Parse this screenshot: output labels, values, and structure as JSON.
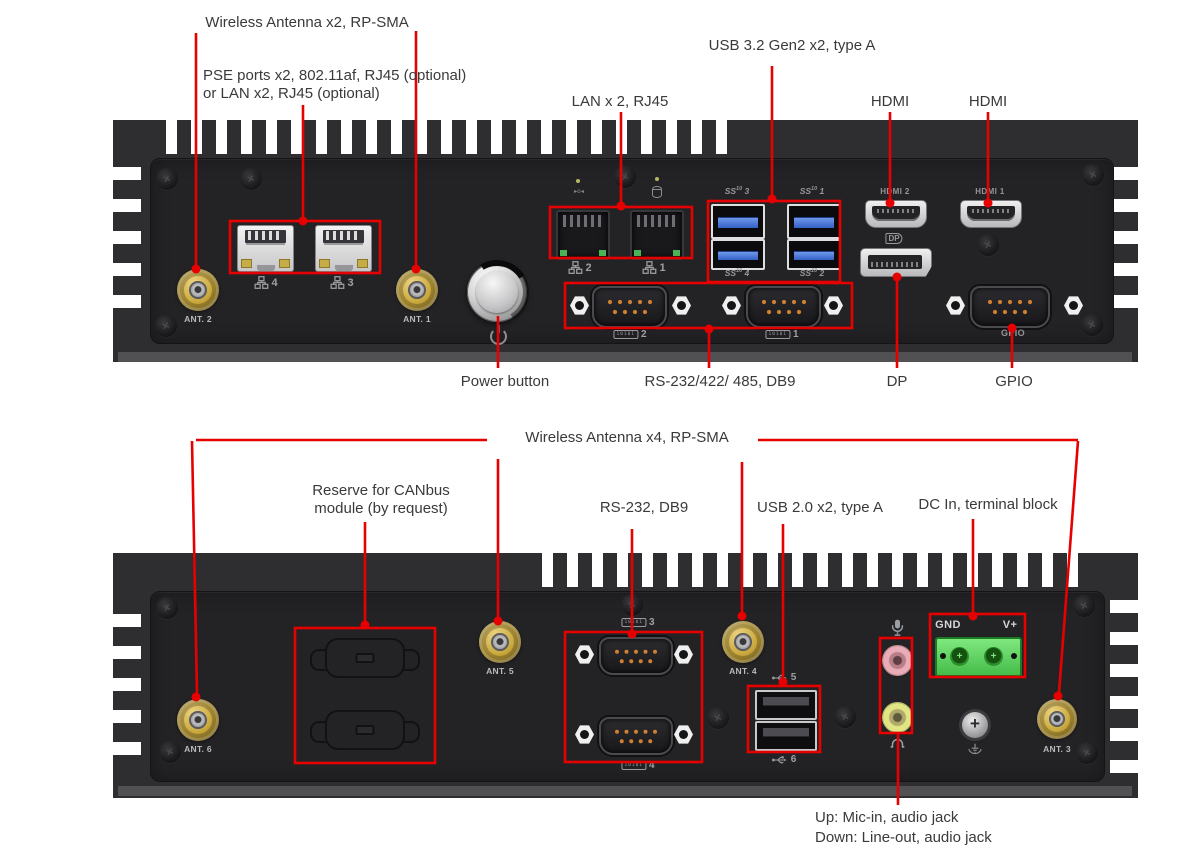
{
  "colors": {
    "annotation_red": "#e60000",
    "chassis_gray": "#2e2e30",
    "faceplate_gray": "#232326",
    "antenna_gold": "#c9a83d",
    "usb3_blue": "#3f6fd8",
    "terminal_green": "#57d157",
    "mic_jack_pink": "#eaacb6",
    "lineout_jack_lime": "#e2e584"
  },
  "top_view": {
    "callouts": {
      "wireless_antenna": "Wireless Antenna x2, RP-SMA",
      "pse_line1": "PSE ports x2, 802.11af, RJ45 (optional)",
      "pse_line2": "or LAN x2, RJ45 (optional)",
      "lan": "LAN x 2, RJ45",
      "usb": "USB 3.2 Gen2 x2, type A",
      "hdmi_left": "HDMI",
      "hdmi_right": "HDMI",
      "power_button": "Power button",
      "serial": "RS-232/422/ 485, DB9",
      "dp": "DP",
      "gpio": "GPIO"
    },
    "panel": {
      "ant2_label": "ANT. 2",
      "ant1_label": "ANT. 1",
      "pse_port_numbers": [
        "4",
        "3"
      ],
      "lan_port_numbers": [
        "2",
        "1"
      ],
      "usb_ss_prefix": "SS",
      "usb_ss_sup": "10",
      "usb_port_numbers": [
        "3",
        "1",
        "4",
        "2"
      ],
      "serial_port_numbers": [
        "2",
        "1"
      ],
      "hdmi_port_labels": [
        "HDMI 2",
        "HDMI 1"
      ],
      "gpio_label": "GPIO"
    }
  },
  "bottom_view": {
    "callouts": {
      "wireless_antenna": "Wireless Antenna x4, RP-SMA",
      "canbus_line1": "Reserve for CANbus",
      "canbus_line2": "module (by request)",
      "serial": "RS-232, DB9",
      "usb": "USB 2.0 x2, type A",
      "dc_in": "DC In, terminal block",
      "audio_line1": "Up: Mic-in, audio jack",
      "audio_line2": "Down: Line-out, audio jack"
    },
    "panel": {
      "ant6_label": "ANT. 6",
      "ant5_label": "ANT. 5",
      "ant4_label": "ANT. 4",
      "ant3_label": "ANT. 3",
      "serial_port_numbers": [
        "3",
        "4"
      ],
      "usb_port_numbers": [
        "5",
        "6"
      ],
      "terminal_gnd": "GND",
      "terminal_vplus": "V+"
    }
  },
  "icons": {
    "serial_port_icon_text": "10101",
    "lan_led_left_glyph": "▸o◂",
    "dp_logo_text": "DP"
  }
}
